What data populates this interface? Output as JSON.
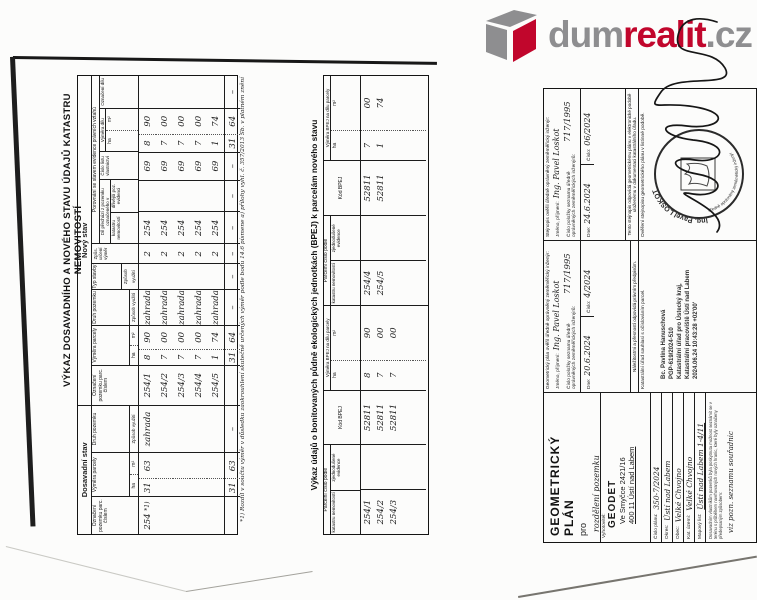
{
  "logo": {
    "part1": "dum",
    "part2": "realit",
    "part3": ".cz",
    "gray": "#8e8e90",
    "red": "#c1062c"
  },
  "vykaz": {
    "title": "VÝKAZ DOSAVADNÍHO A NOVÉHO STAVU ÚDAJŮ KATASTRU NEMOVITOSTÍ",
    "old_label": "Dosavadní stav",
    "new_label": "Nový stav",
    "col_parcel": "Označení pozemku parc. číslem",
    "col_vymera": "Výměra parcely",
    "col_ha": "ha",
    "col_m2": "m²",
    "col_druh": "Druh pozemku",
    "col_zpusob_vyuziti": "Způsob využití",
    "col_typ_stavby": "Typ stavby",
    "col_zpusob_urceni": "Způs. určení výměr",
    "col_porovnani": "Porovnání se stavem evidence právních vztahů",
    "col_dil_prechazi": "Díl přechází z pozemku označeného v",
    "col_kn": "katastru nemovitostí",
    "col_dpe": "dřívější poz. evidenci",
    "col_lv": "Číslo listu vlastnictví",
    "col_vymera_dilu": "Výměra dílu",
    "col_oznaceni_dilu": "Označení dílu",
    "old_row": {
      "parcel": "254",
      "note": "*1)",
      "ha": "31",
      "m2": "63",
      "druh": "zahrada"
    },
    "new_rows": [
      {
        "parcel": "254/1",
        "ha": "8",
        "m2": "90",
        "druh": "zahrada",
        "zpus": "2",
        "kn": "254",
        "lv": "69",
        "dha": "8",
        "dm2": "90"
      },
      {
        "parcel": "254/2",
        "ha": "7",
        "m2": "00",
        "druh": "zahrada",
        "zpus": "2",
        "kn": "254",
        "lv": "69",
        "dha": "7",
        "dm2": "00"
      },
      {
        "parcel": "254/3",
        "ha": "7",
        "m2": "00",
        "druh": "zahrada",
        "zpus": "2",
        "kn": "254",
        "lv": "69",
        "dha": "7",
        "dm2": "00"
      },
      {
        "parcel": "254/4",
        "ha": "7",
        "m2": "00",
        "druh": "zahrada",
        "zpus": "2",
        "kn": "254",
        "lv": "69",
        "dha": "7",
        "dm2": "00"
      },
      {
        "parcel": "254/5",
        "ha": "1",
        "m2": "74",
        "druh": "zahrada",
        "zpus": "2",
        "kn": "254",
        "lv": "69",
        "dha": "1",
        "dm2": "74"
      }
    ],
    "totals": {
      "old_ha": "31",
      "old_m2": "63",
      "new_ha": "31",
      "new_m2": "64",
      "dil_ha": "31",
      "dil_m2": "64",
      "dash": "–"
    },
    "footnote": "*1) Rozdíl v součtu výměr v důsledku zaokrouhlení skutečně určených výměr podle bodu 14.6 písmene a) přílohy vyhl. č. 357/2013 Sb. v platném znění"
  },
  "bpej": {
    "title": "Výkaz údajů o bonitovaných půdně ekologických jednotkách (BPEJ) k parcelám nového stavu",
    "col_parcelni": "Parcelní číslo podle",
    "col_kn": "katastru nemovitostí",
    "col_ze": "zjednodušené evidence",
    "col_kod": "Kód BPEJ",
    "col_vymera": "Výměra BPEJ na dílu parcely",
    "col_ha": "ha",
    "col_m2": "m²",
    "rows": [
      {
        "parcel": "254/1",
        "kod": "52811",
        "ha": "8",
        "m2": "90"
      },
      {
        "parcel": "254/2",
        "kod": "52811",
        "ha": "7",
        "m2": "00"
      },
      {
        "parcel": "254/3",
        "kod": "52811",
        "ha": "7",
        "m2": "00"
      },
      {
        "parcel": "254/4",
        "kod": "52811",
        "ha": "7",
        "m2": "00"
      },
      {
        "parcel": "254/5",
        "kod": "52811",
        "ha": "1",
        "m2": "74"
      }
    ]
  },
  "titleblock": {
    "gp": "GEOMETRICKÝ PLÁN",
    "pro": "pro",
    "purpose": "rozdělení pozemku",
    "vyhotovitel_label": "Vyhotovitel:",
    "firm": "GEODET",
    "addr1": "Ve Smyčce 2421/16",
    "addr2": "400 11 Ústí nad Labem",
    "rows": [
      {
        "label": "Číslo plánu:",
        "value": "350-7/2024"
      },
      {
        "label": "Okres:",
        "value": "Ústí nad Labem"
      },
      {
        "label": "Obec:",
        "value": "Velké Chvojno"
      },
      {
        "label": "Kat. území:",
        "value": "Velké Chvojno"
      },
      {
        "label": "Mapový list:",
        "value": "Ústí nad Labem 1-4/11"
      }
    ],
    "note": "Dosavadním vlastníkům pozemků byla poskytnuta možnost seznámit se v terénu s průběhem navrhovaných nových hranic, které byly označeny předepsaným způsobem:",
    "note_hand": "viz pozn. seznamu souřadnic",
    "gp_overil": {
      "header": "Geometrický plán ověřil úředně oprávněný zeměměřický inženýr:",
      "jmeno_label": "Jméno, příjmení:",
      "jmeno": "Ing. Pavel Loskot",
      "polozka_label": "Číslo položky seznamu úředně oprávněných zeměměřických inženýrů:",
      "polozka": "717/1995",
      "dne_label": "Dne:",
      "dne": "20.6.2024",
      "cislo_label": "Číslo:",
      "cislo": "4/2024",
      "footer": "Náležitostmi a přesností odpovídá právním předpisům."
    },
    "stejnopis": {
      "header": "Stejnopis ověřil úředně oprávněný zeměměřický inženýr:",
      "jmeno_label": "Jméno, příjmení:",
      "jmeno": "Ing. Pavel Loskot",
      "polozka_label": "Číslo položky seznamu úředně oprávněných zeměměřických inženýrů:",
      "polozka": "717/1995",
      "dne_label": "Dne:",
      "dne": "24.6.2024",
      "cislo_label": "Číslo:",
      "cislo": "06/2024",
      "footer": "Tento stejnopis odpovídá geometrickému plánu v elektronické podobě uloženému v dokumentaci katastrálního úřadu."
    },
    "katurad": {
      "header": "Katastrální úřad souhlasí s očíslováním parcel.",
      "sig1": "Bc. Pavlína Hanuschová",
      "sig2": "PGP-619/2024-510",
      "sig3": "Katastrální úřad pro Ústecký kraj,",
      "sig4": "Katastrální pracoviště Ústí nad Labem",
      "sig5": "2024.06.24 10:43:28 +02'00'"
    },
    "overeni": {
      "header": "Ověření stejnopisu geometrického plánu v listinné podobě.",
      "stamp_name": "Ing. Pavel LOSKOT",
      "stamp_sub": "úředně oprávněný zeměměřický inženýr"
    }
  }
}
